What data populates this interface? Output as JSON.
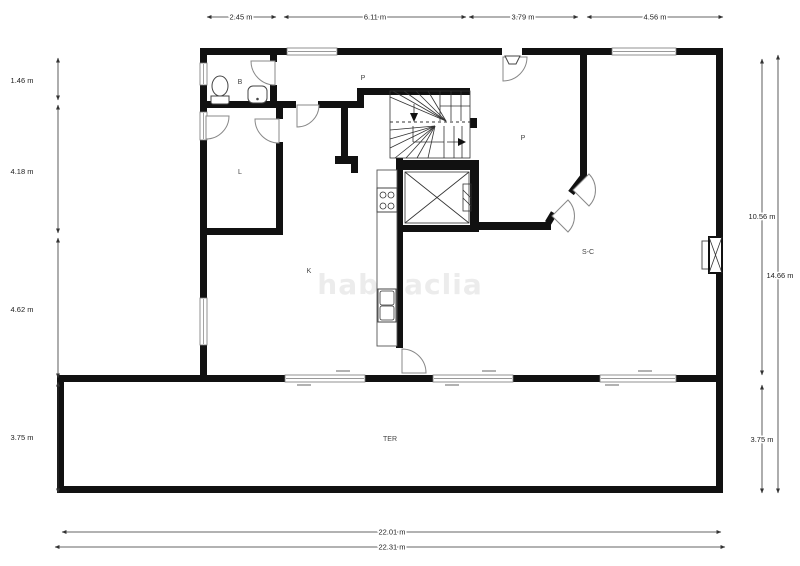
{
  "watermark": "habitaclia",
  "rooms": {
    "bathroom": "B",
    "hall_top": "P",
    "hall_right": "P",
    "laundry": "L",
    "kitchen": "K",
    "living": "S-C",
    "terrace": "TER"
  },
  "dims": {
    "top": [
      "2.45 m",
      "6.11 m",
      "3.79 m",
      "4.56 m"
    ],
    "left": [
      "1.46 m",
      "4.18 m",
      "4.62 m",
      "3.75 m"
    ],
    "right_inner": [
      "10.56 m",
      "3.75 m"
    ],
    "right_outer": [
      "14.66 m"
    ],
    "bottom": [
      "22.01 m",
      "22.31 m"
    ]
  },
  "colors": {
    "wall": "#111111",
    "window": "#999999",
    "dimension": "#333333",
    "label": "#444444",
    "watermark": "#ececec",
    "background": "#ffffff"
  }
}
